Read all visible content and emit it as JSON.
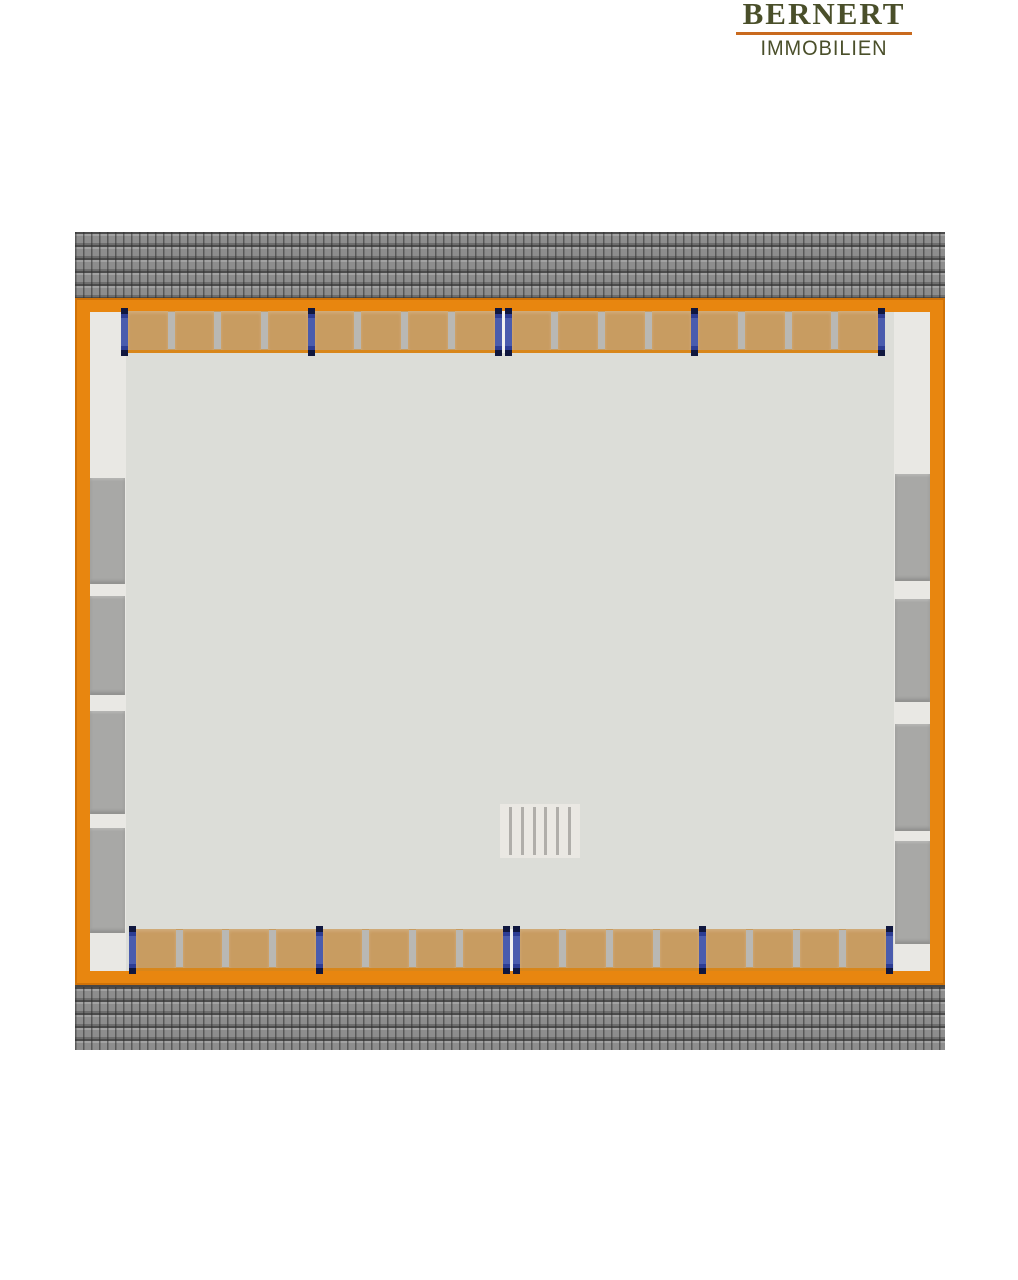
{
  "page": {
    "background": "#ffffff"
  },
  "logo": {
    "company": "BERNERT",
    "tagline": "IMMOBILIEN",
    "text_color": "#4a4f2a",
    "underline_color": "#c96a1e"
  },
  "plan": {
    "type": "floor-plan-top-view",
    "colors": {
      "roof_tile": "#8d8d8d",
      "roof_joint": "#4c4c4c",
      "wall_orange": "#e8860f",
      "floor": "#dcddd8",
      "wood_panel": "#c89c61",
      "panel_divider": "#b9b8b4",
      "support_post": "#2d3d94",
      "side_block": "#a8a8a6",
      "stair_background": "#eae8e3",
      "stair_line": "#b0aeaa"
    },
    "top_row": {
      "bays": 4,
      "panels_per_bay": 4,
      "posts": 5,
      "center_post_double": true
    },
    "bottom_row": {
      "bays": 4,
      "panels_per_bay": 4,
      "posts": 5,
      "center_post_double": true
    },
    "left_blocks": {
      "count": 4
    },
    "right_blocks": {
      "count": 4
    },
    "stairs": {
      "steps": 6
    }
  }
}
